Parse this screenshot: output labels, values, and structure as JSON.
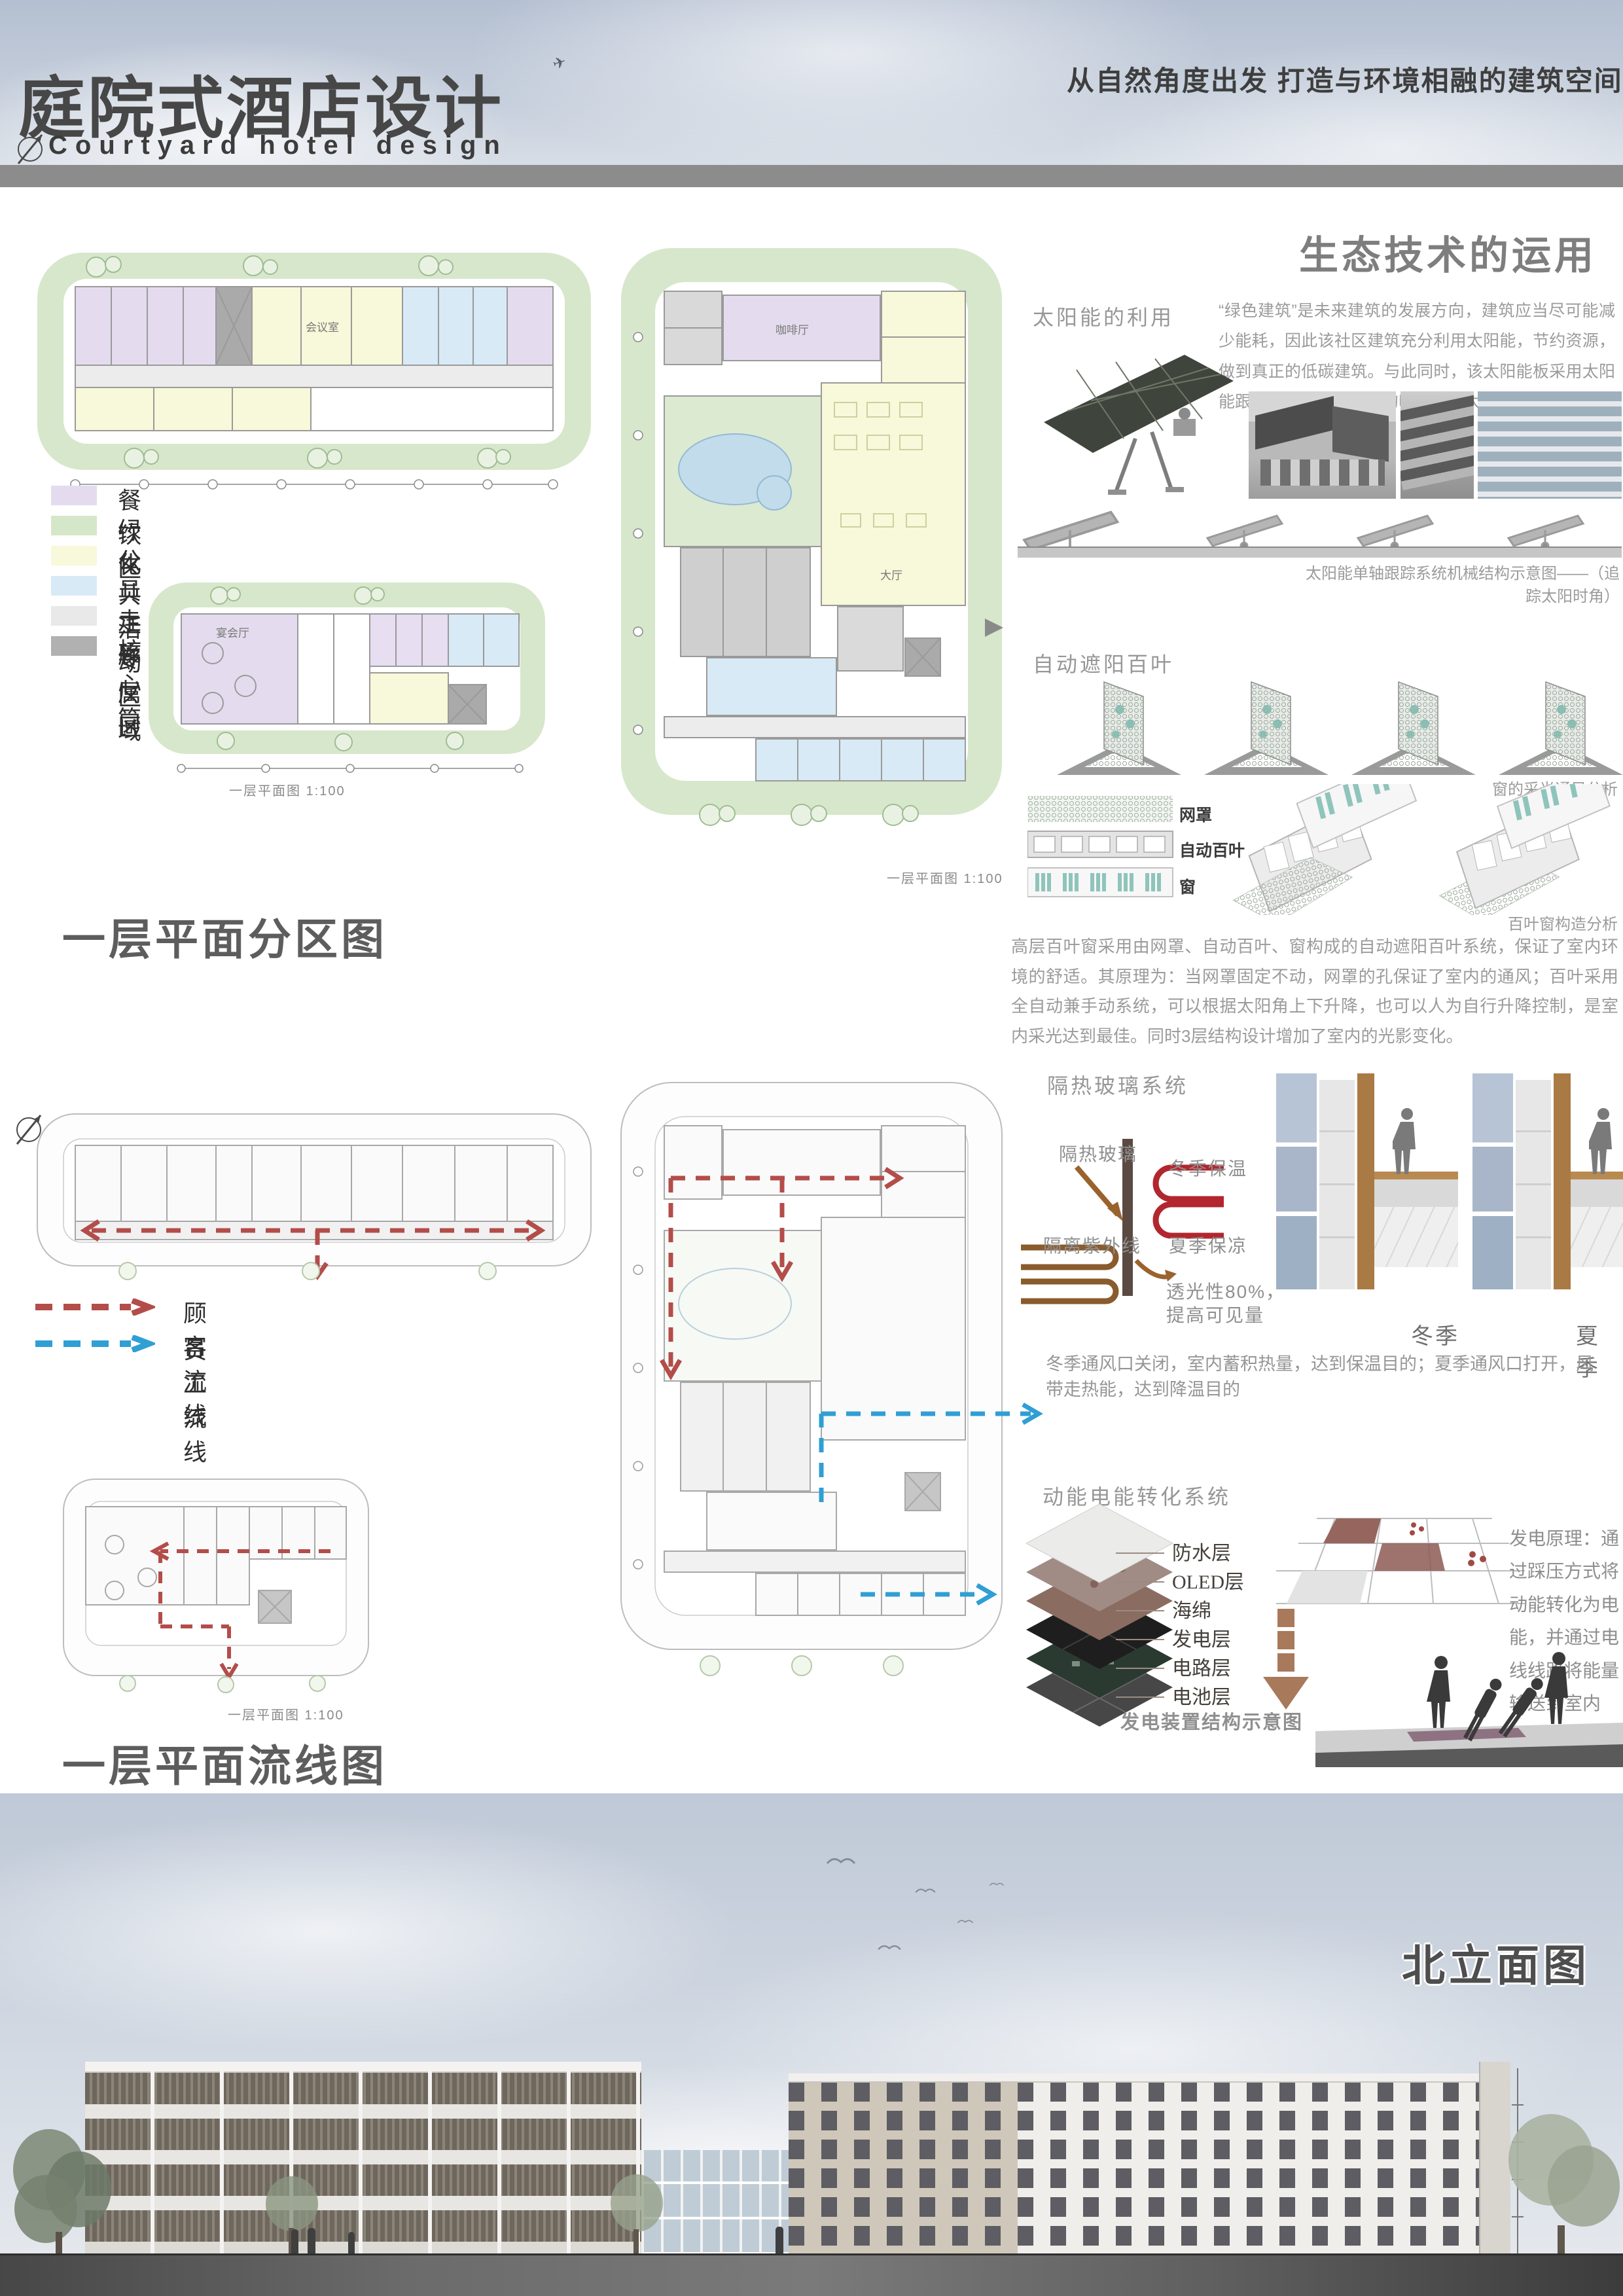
{
  "header": {
    "title_cn": "庭院式酒店设计",
    "title_en": "Courtyard hotel design",
    "slogan": "从自然角度出发 打造与环境相融的建筑空间"
  },
  "eco": {
    "title": "生态技术的运用",
    "solar_heading": "太阳能的利用",
    "solar_paragraph": "“绿色建筑”是未来建筑的发展方向，建筑应当尽可能减少能耗，因此该社区建筑充分利用太阳能，节约资源，做到真正的低碳建筑。与此同时，该太阳能板采用太阳能跟踪系统，最大限度的吸收利用太阳能。",
    "solar_caption": "太阳能单轴跟踪系统机械结构示意图——（追踪太阳时角）",
    "louver_heading": "自动遮阳百叶",
    "louver_caption_top": "窗的采光通风分析",
    "louver_layers": [
      "网罩",
      "自动百叶",
      "窗"
    ],
    "louver_caption_bottom": "百叶窗构造分析",
    "louver_paragraph": "高层百叶窗采用由网罩、自动百叶、窗构成的自动遮阳百叶系统，保证了室内环境的舒适。其原理为：当网罩固定不动，网罩的孔保证了室内的通风；百叶采用全自动兼手动系统，可以根据太阳角上下升降，也可以人为自行升降控制，是室内采光达到最佳。同时3层结构设计增加了室内的光影变化。",
    "glass_heading": "隔热玻璃系统",
    "glass_label": "隔热玻璃",
    "glass_winter": "冬季保温",
    "glass_uv": "隔离紫外线",
    "glass_summer": "夏季保凉",
    "glass_light_1": "透光性80%，",
    "glass_light_2": "提高可见量",
    "season_winter": "冬季",
    "season_summer": "夏季",
    "glass_paragraph": "冬季通风口关闭，室内蓄积热量，达到保温目的；夏季通风口打开，风带走热能，达到降温目的",
    "kinetic_heading": "动能电能转化系统",
    "kinetic_layers": [
      "防水层",
      "OLED层",
      "海绵",
      "发电层",
      "电路层",
      "电池层"
    ],
    "kinetic_caption": "发电装置结构示意图",
    "kinetic_principle": "发电原理：通过踩压方式将动能转化为电能，并通过电线线路将能量输送到室内"
  },
  "zoning": {
    "heading": "一层平面分区图",
    "legend": [
      {
        "label": "餐饮区",
        "color": "#e4dcee"
      },
      {
        "label": "绿化",
        "color": "#d5e7c9"
      },
      {
        "label": "公共活动区域",
        "color": "#f8f8da"
      },
      {
        "label": "员工专属区",
        "color": "#d8eaf6"
      },
      {
        "label": "走廊",
        "color": "#e9e9e9"
      },
      {
        "label": "核心筒",
        "color": "#b1b1b1"
      }
    ]
  },
  "flow": {
    "heading": "一层平面流线图",
    "customer": {
      "label": "顾客流线",
      "color": "#b34d4a"
    },
    "staff": {
      "label": "员工流线",
      "color": "#2f9fd4"
    }
  },
  "plans": {
    "caption": "一层平面图 1:100",
    "rooms": {
      "meeting": "会议室",
      "cafe": "咖啡厅",
      "banquet": "宴会厅",
      "hall": "大厅"
    }
  },
  "elevation": {
    "heading": "北立面图"
  }
}
